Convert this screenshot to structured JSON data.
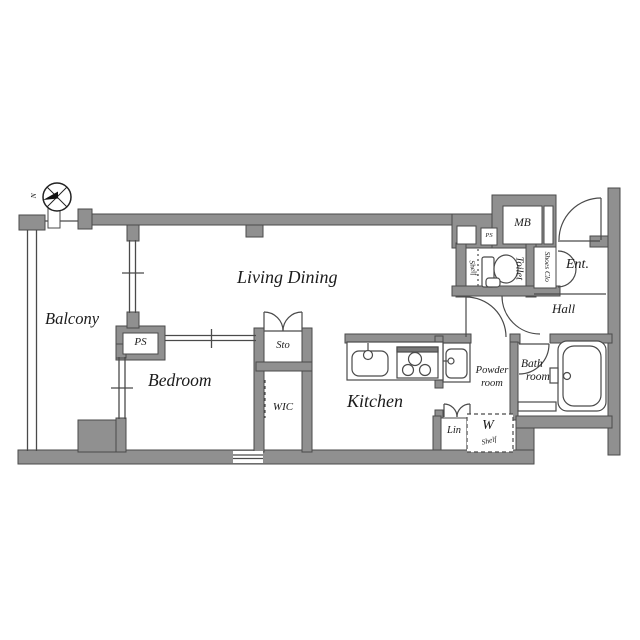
{
  "plan_type": "apartment floor plan",
  "colors": {
    "wall_fill": "#909090",
    "wall_stroke": "#4a4a4a",
    "line": "#4a4a4a",
    "text": "#1b1b1b",
    "background": "#ffffff"
  },
  "labels": {
    "balcony": "Balcony",
    "living_dining": "Living Dining",
    "bedroom": "Bedroom",
    "kitchen": "Kitchen",
    "ps_balcony": "PS",
    "ps_meter": "PS",
    "sto": "Sto",
    "wic": "WIC",
    "mb": "MB",
    "toilet": "Toilet",
    "toilet_shelf": "Shelf",
    "shoes_closet": "Shoes Clo",
    "entrance": "Ent.",
    "hall": "Hall",
    "powder_line1": "Powder",
    "powder_line2": "room",
    "bath_line1": "Bath",
    "bath_line2": "room",
    "linen": "Lin",
    "washer_letter": "W",
    "washer_shelf": "Shelf",
    "compass_north": "N"
  }
}
